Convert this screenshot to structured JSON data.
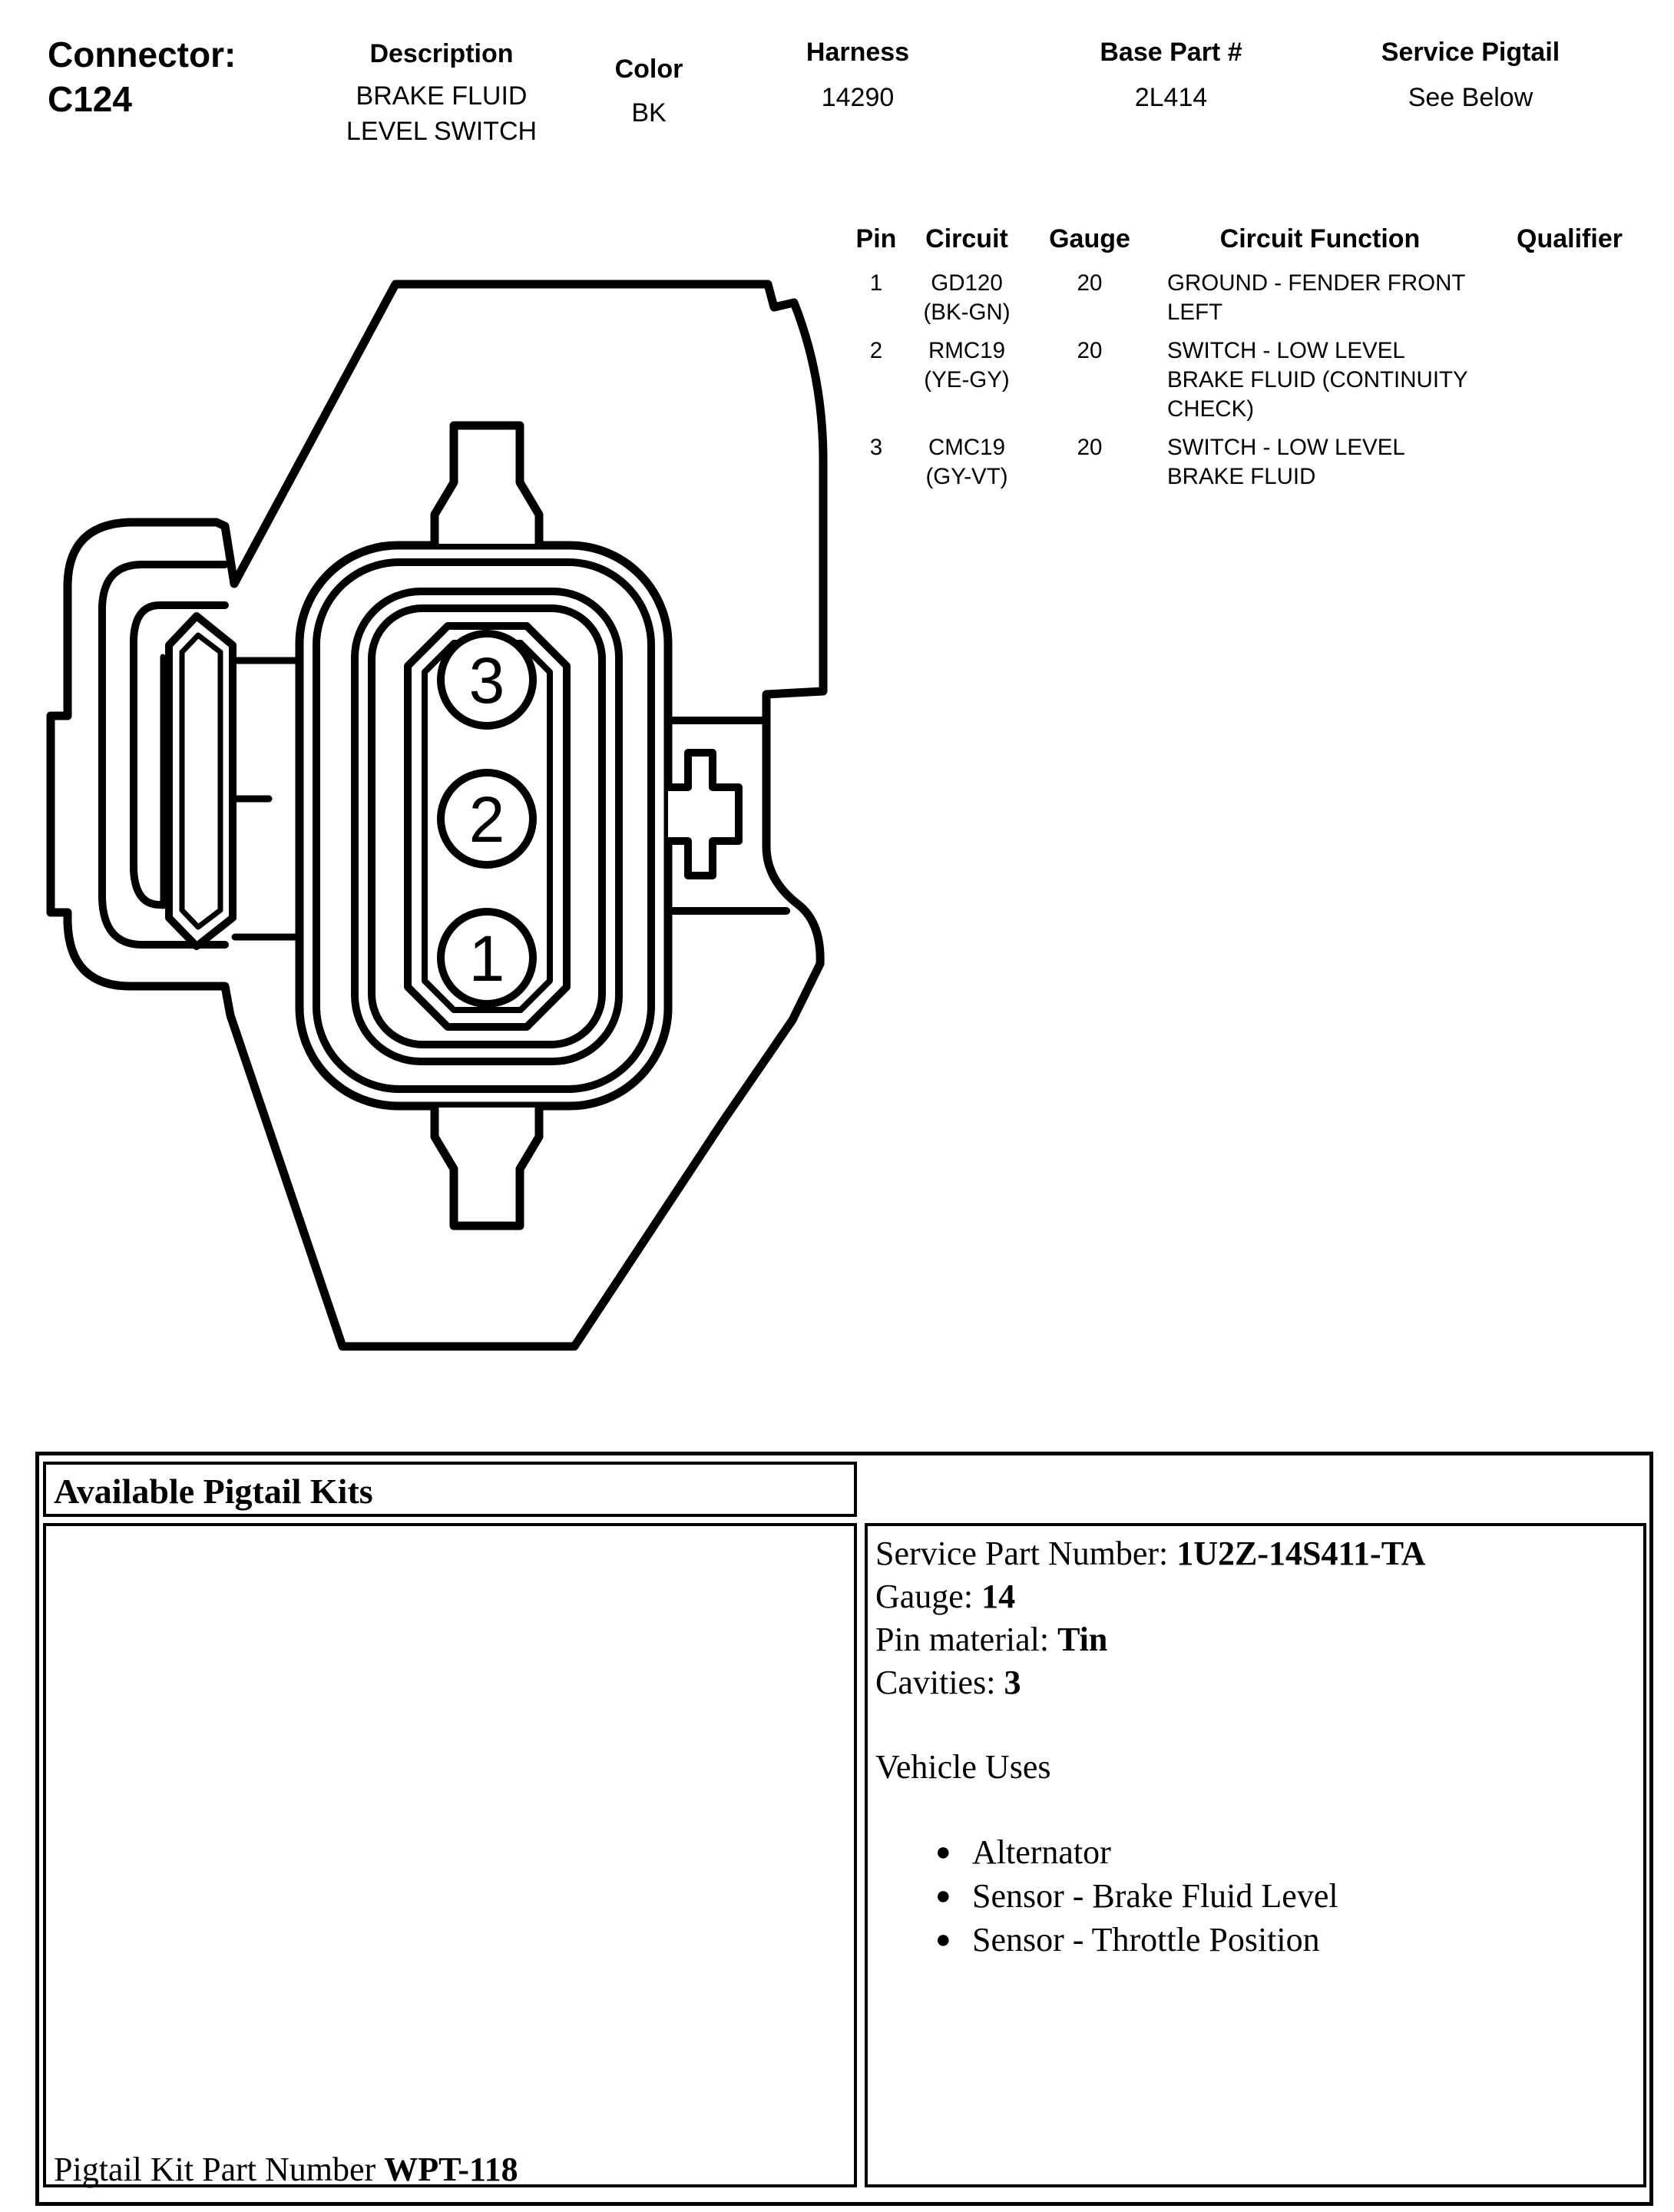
{
  "header": {
    "connector_label": "Connector:",
    "connector_id": "C124",
    "description": {
      "label": "Description",
      "value": "BRAKE FLUID\nLEVEL SWITCH"
    },
    "color": {
      "label": "Color",
      "value": "BK"
    },
    "harness": {
      "label": "Harness",
      "value": "14290"
    },
    "base_part": {
      "label": "Base Part #",
      "value": "2L414"
    },
    "service_pigtail": {
      "label": "Service Pigtail",
      "value": "See Below"
    }
  },
  "pin_table": {
    "headers": [
      "Pin",
      "Circuit",
      "Gauge",
      "Circuit Function",
      "Qualifier"
    ],
    "rows": [
      {
        "pin": "1",
        "circuit": "GD120",
        "circuit_color": "(BK-GN)",
        "gauge": "20",
        "function": "GROUND - FENDER FRONT\nLEFT",
        "qualifier": ""
      },
      {
        "pin": "2",
        "circuit": "RMC19",
        "circuit_color": "(YE-GY)",
        "gauge": "20",
        "function": "SWITCH - LOW LEVEL\nBRAKE FLUID (CONTINUITY\nCHECK)",
        "qualifier": ""
      },
      {
        "pin": "3",
        "circuit": "CMC19",
        "circuit_color": "(GY-VT)",
        "gauge": "20",
        "function": "SWITCH - LOW LEVEL\nBRAKE FLUID",
        "qualifier": ""
      }
    ]
  },
  "diagram": {
    "pin_labels": [
      "3",
      "2",
      "1"
    ]
  },
  "pigtail": {
    "box_title": "Available Pigtail Kits",
    "details": [
      {
        "label": "Service Part Number: ",
        "value": "1U2Z-14S411-TA"
      },
      {
        "label": "Gauge: ",
        "value": "14"
      },
      {
        "label": "Pin material: ",
        "value": "Tin"
      },
      {
        "label": "Cavities: ",
        "value": "3"
      }
    ],
    "vehicle_uses_title": "Vehicle Uses",
    "vehicle_uses": [
      "Alternator",
      "Sensor - Brake Fluid Level",
      "Sensor - Throttle Position"
    ],
    "kit_part_label": "Pigtail Kit Part Number ",
    "kit_part_number": "WPT-118"
  },
  "icons": {
    "bullet": "●"
  },
  "colors": {
    "ink": "#000000",
    "paper": "#ffffff"
  }
}
